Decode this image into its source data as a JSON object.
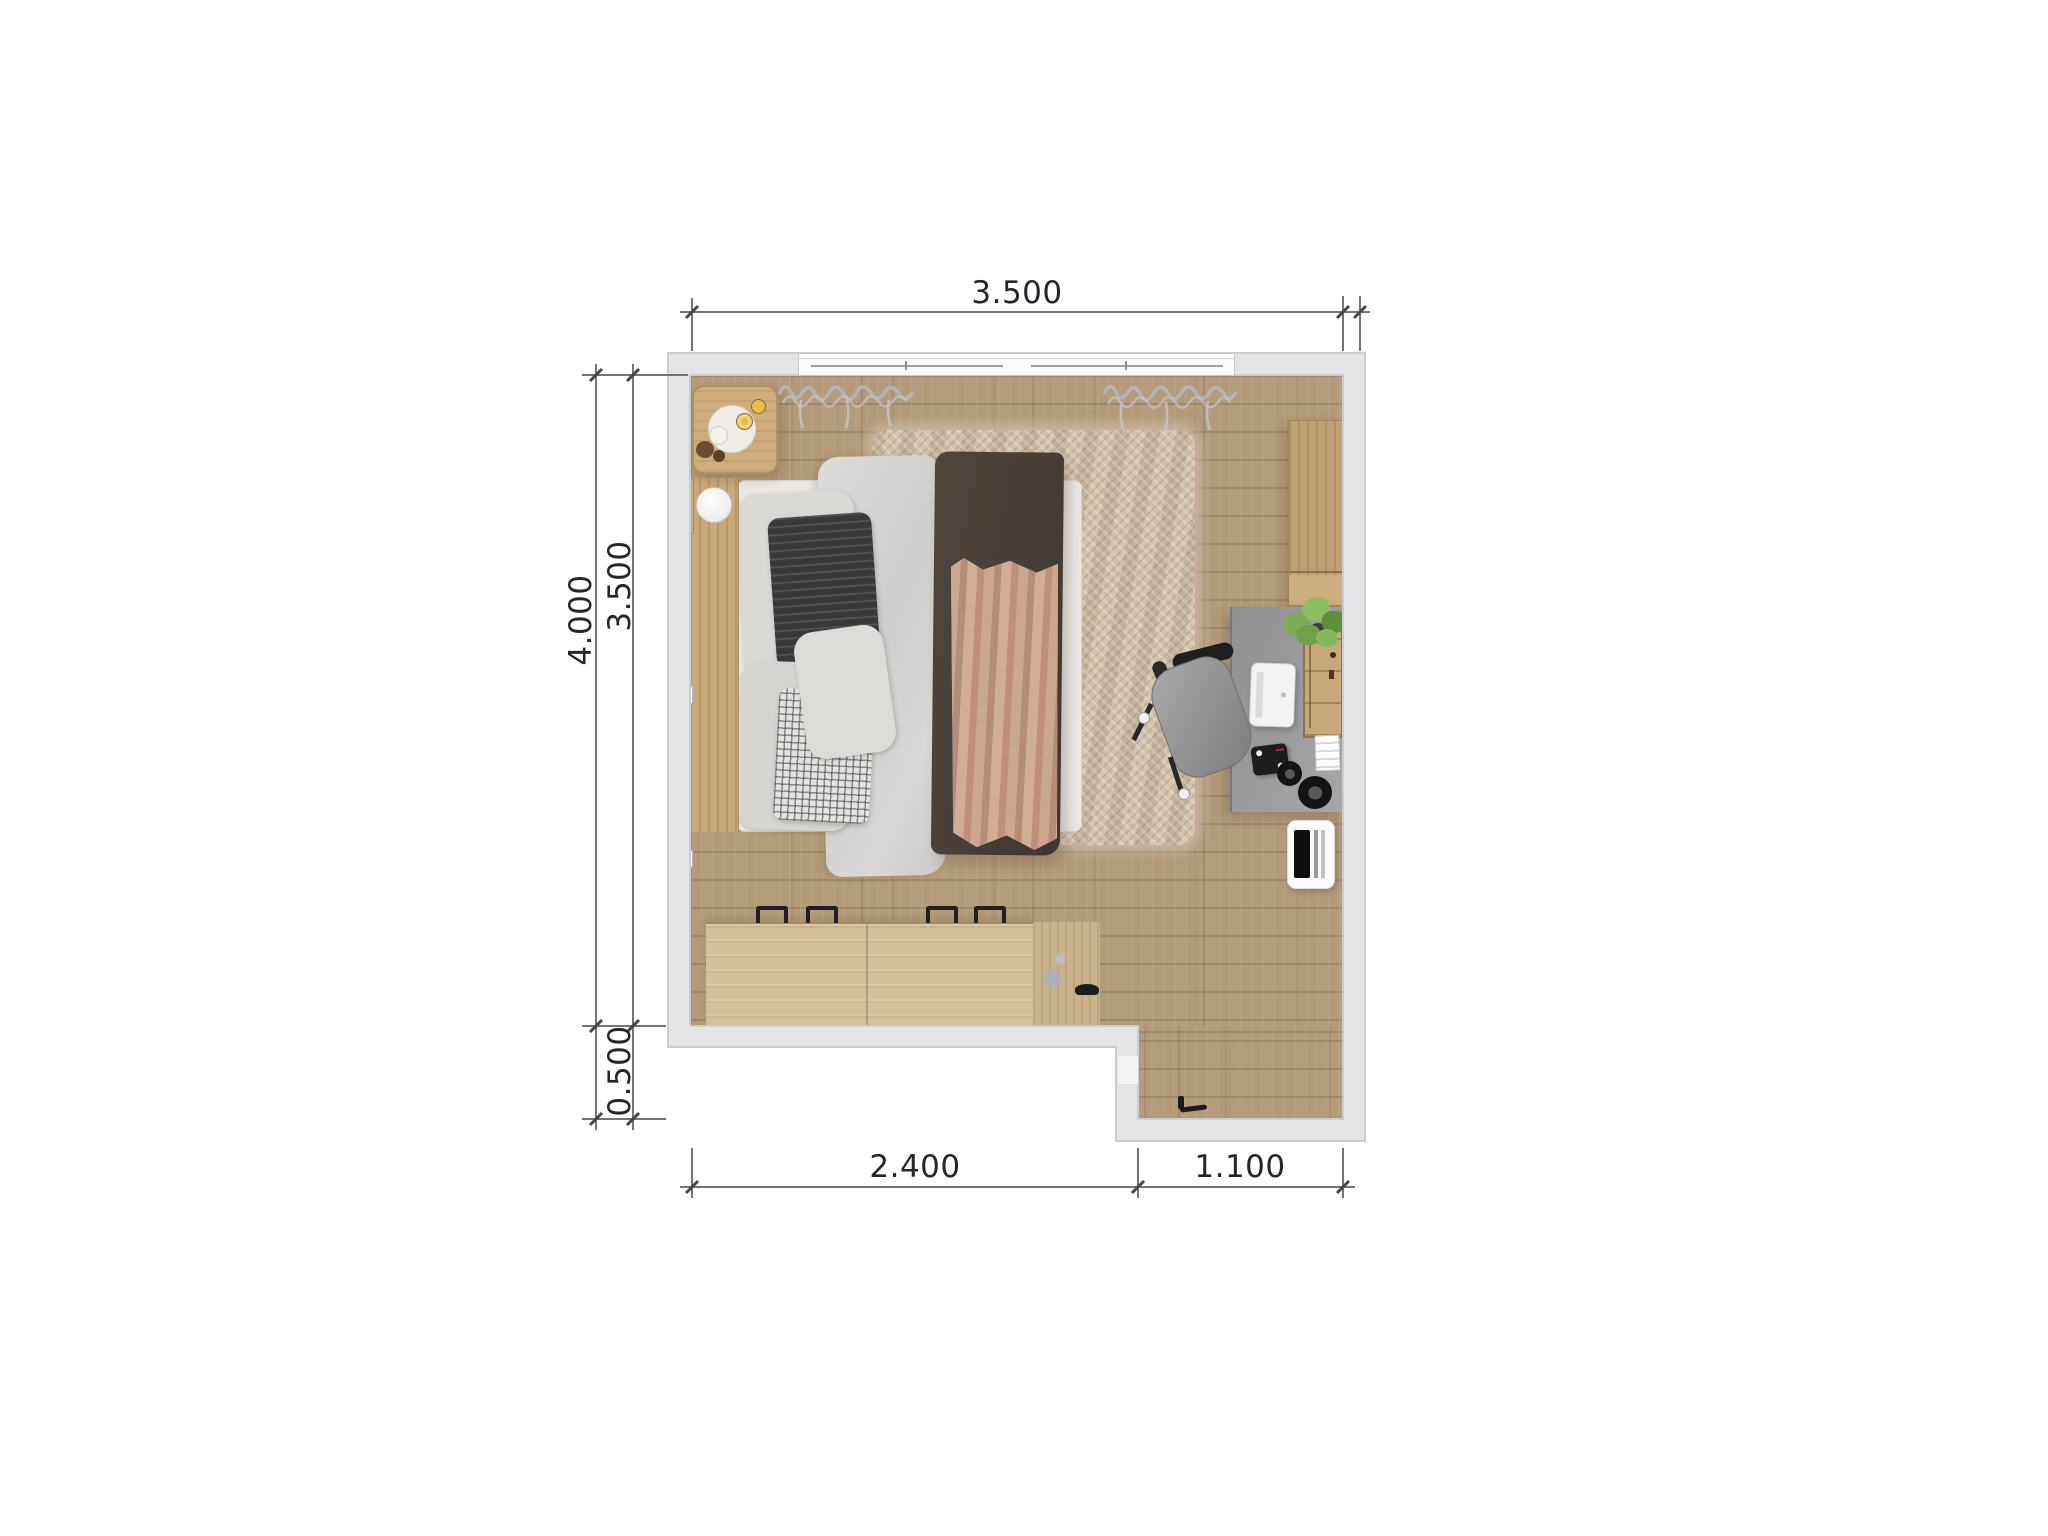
{
  "page": {
    "title": "bedroom-floor-plan-top-view",
    "background": "#ffffff"
  },
  "dimensions": {
    "top_width": "3.500",
    "left_total_height": "4.000",
    "left_room_height": "3.500",
    "left_nook_height": "0.500",
    "bottom_left_width": "2.400",
    "bottom_right_width": "1.100"
  },
  "colors": {
    "wall_fill": "#e4e4e6",
    "wall_edge": "#cdcdcf",
    "floor_wood": "#b49b79",
    "rug": "#ccbba4",
    "desk": "#9b9b9d",
    "blanket_dark": "#4a423a",
    "blanket_tan": "#c69c85",
    "duvet": "#d4d3d1",
    "furniture_wood": "#c9a87c",
    "dimension_text": "#23262c",
    "dimension_line": "#73737a",
    "plant_green": "#7dad55"
  },
  "furniture": {
    "bed": "double-bed",
    "headboard": "wood-headboard",
    "table_lamp": "sphere-lamp",
    "nightstand": "bedside-table-with-flowers",
    "rug": "shag-rug",
    "wardrobe": "wardrobe-cabinet",
    "desk": "work-desk",
    "chair": "office-chair",
    "laptop": "laptop",
    "plant": "potted-plant",
    "desk_shelf": "desktop-organizer-shelf",
    "controller": "audio-controller",
    "headphones": "headphones",
    "papers": "paper-stack",
    "white_device": "white-appliance",
    "dresser": "low-dresser",
    "window": "double-window",
    "curtains": "curtains",
    "door_handle": "door-handle"
  }
}
